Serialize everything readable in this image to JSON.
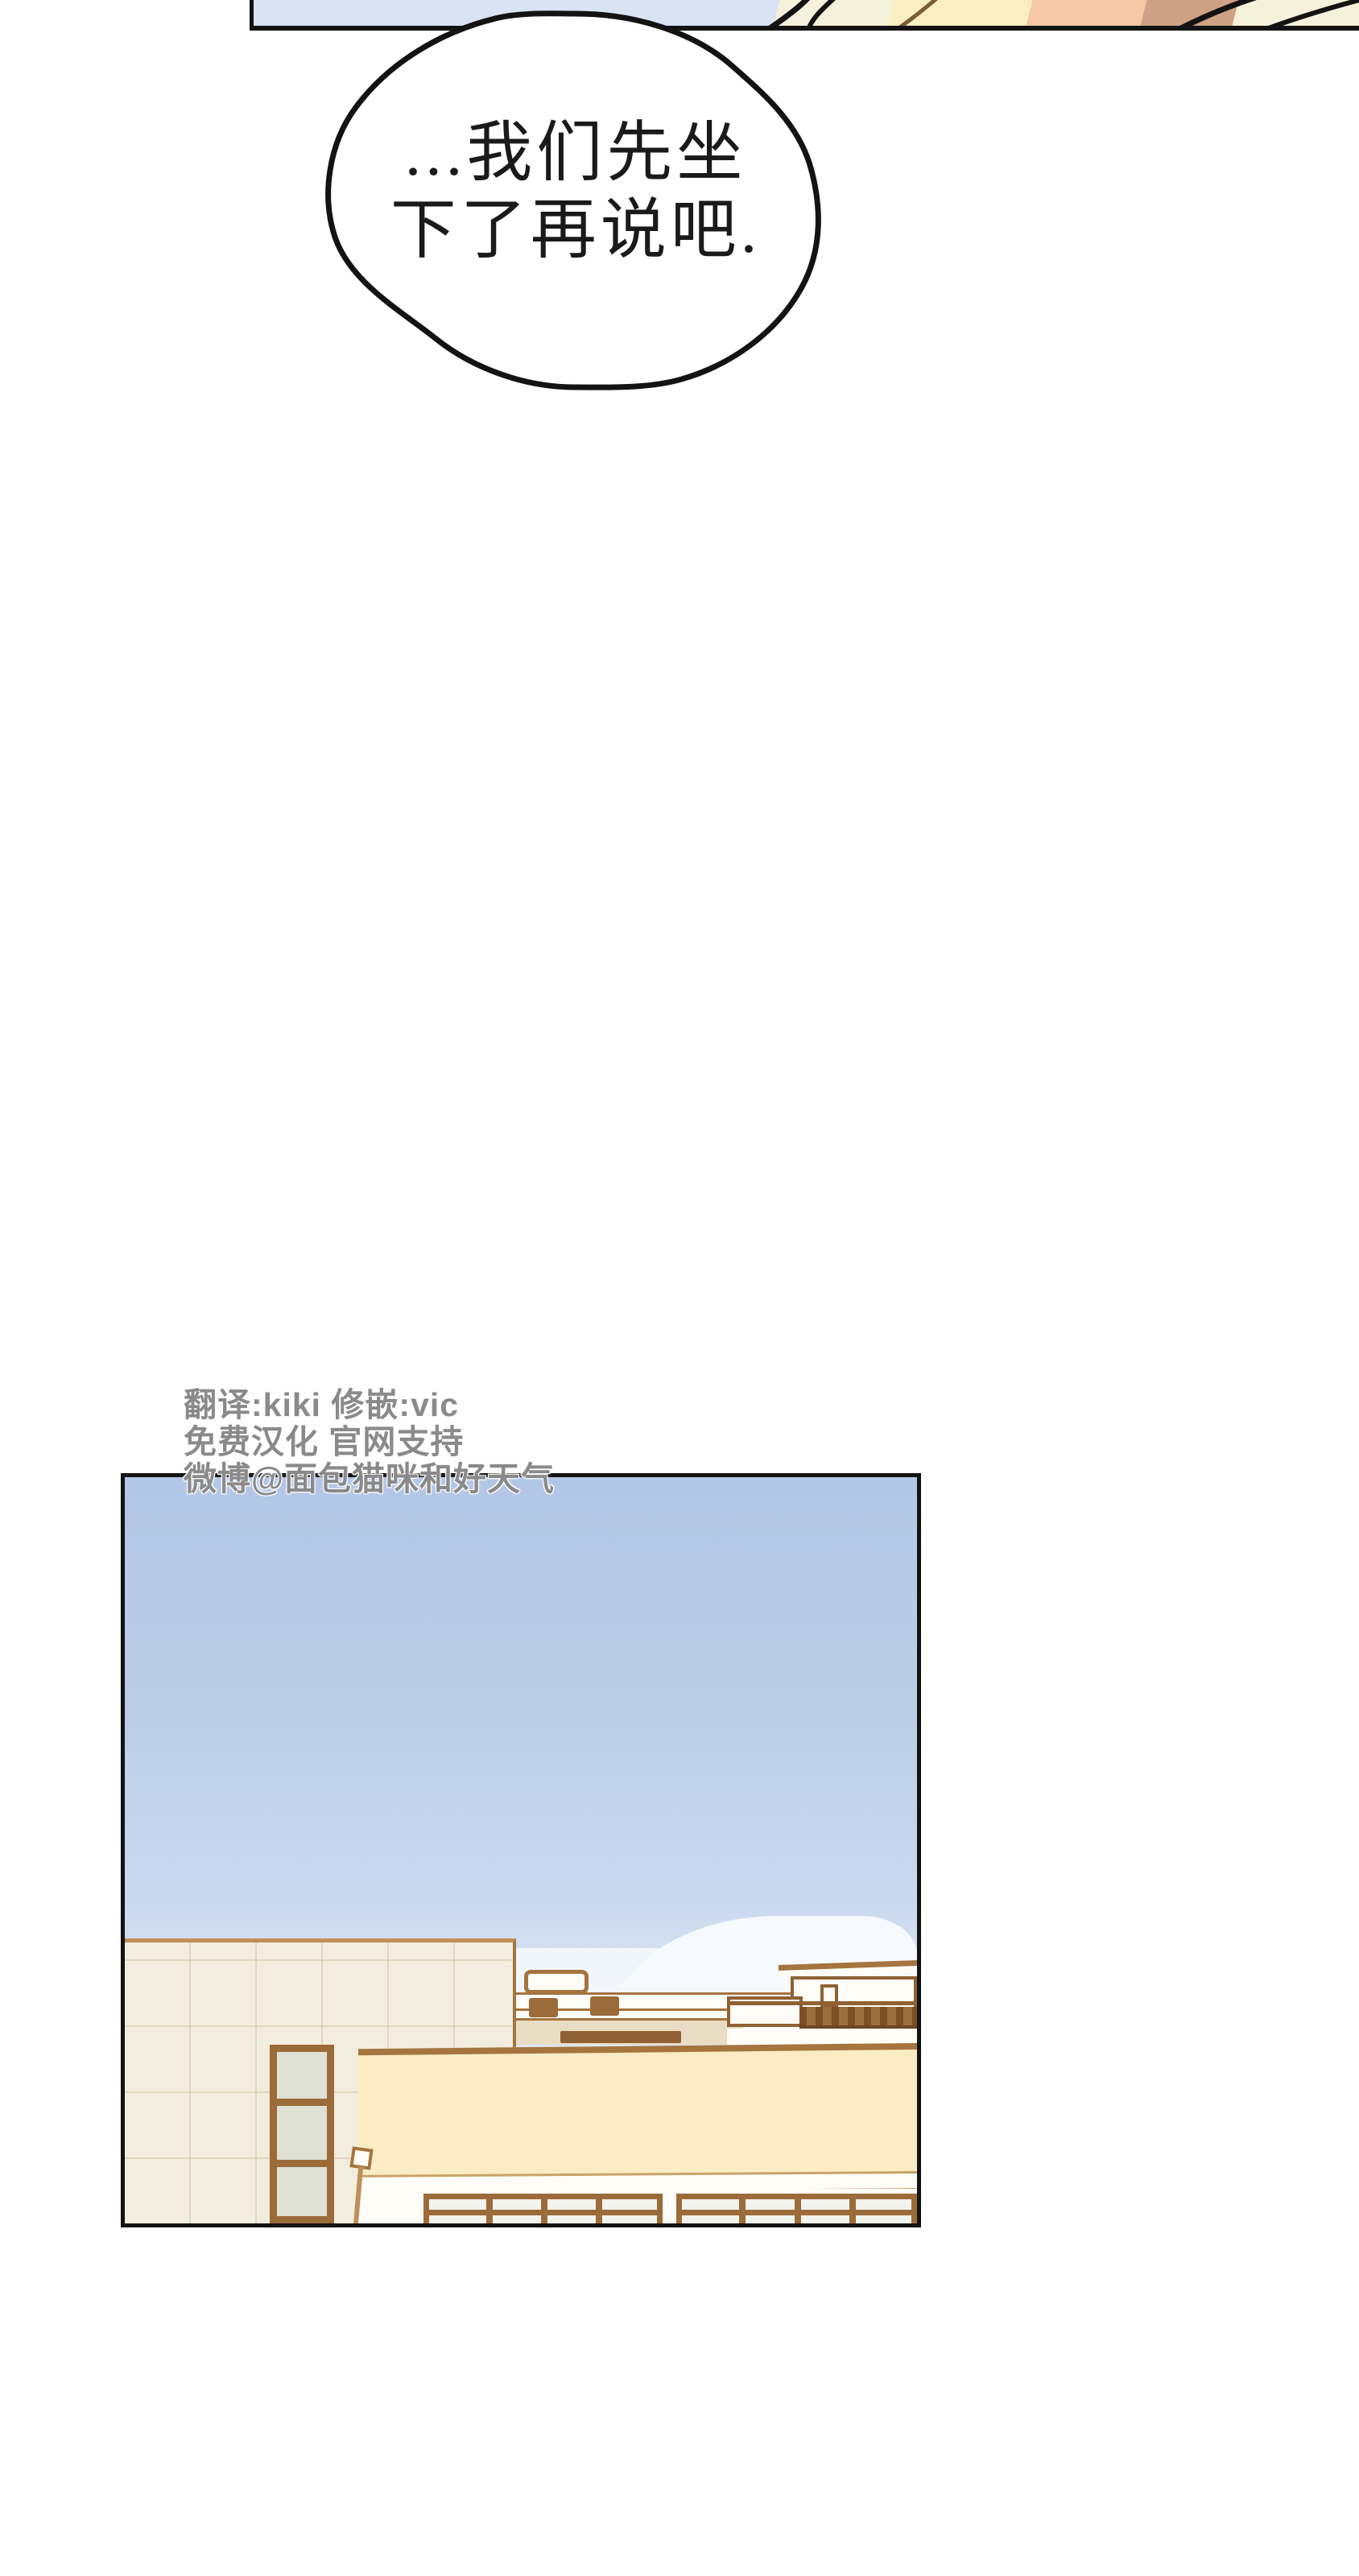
{
  "speech_bubble": {
    "lines": [
      "...我们先坐",
      "下了再说吧."
    ]
  },
  "credits": {
    "lines": [
      "翻译:kiki 修嵌:vic",
      "免费汉化 官网支持",
      "微博@面包猫咪和好天气"
    ]
  },
  "colors": {
    "page_bg": "#ffffff",
    "ink": "#131313",
    "bubble_text": "#1a1a1a",
    "credits_gray": "#8a8a8a",
    "top_sky": "#d9e3f4",
    "hair_cream": "#f6f1da",
    "hair_yellow": "#faefc2",
    "skin_peach": "#f6c8a6",
    "shade_tan": "#cfa285",
    "sky_top": "#b2c6e6",
    "sky_horizon": "#dfe8f5",
    "cloud": "#f6f9fd",
    "building_cream": "#f2edde",
    "trim_tan": "#bf8f5a",
    "trim_brown": "#a5743f",
    "frame_brown": "#9c6b3a",
    "dark_brown": "#8f6134",
    "railing_dark": "#7c5026",
    "glass": "#dde0d2",
    "awning": "#fbecc3",
    "ledge_cream": "#e9dcc5",
    "wall_white": "#fdfcf6",
    "fascia_line": "#c9a36a"
  }
}
